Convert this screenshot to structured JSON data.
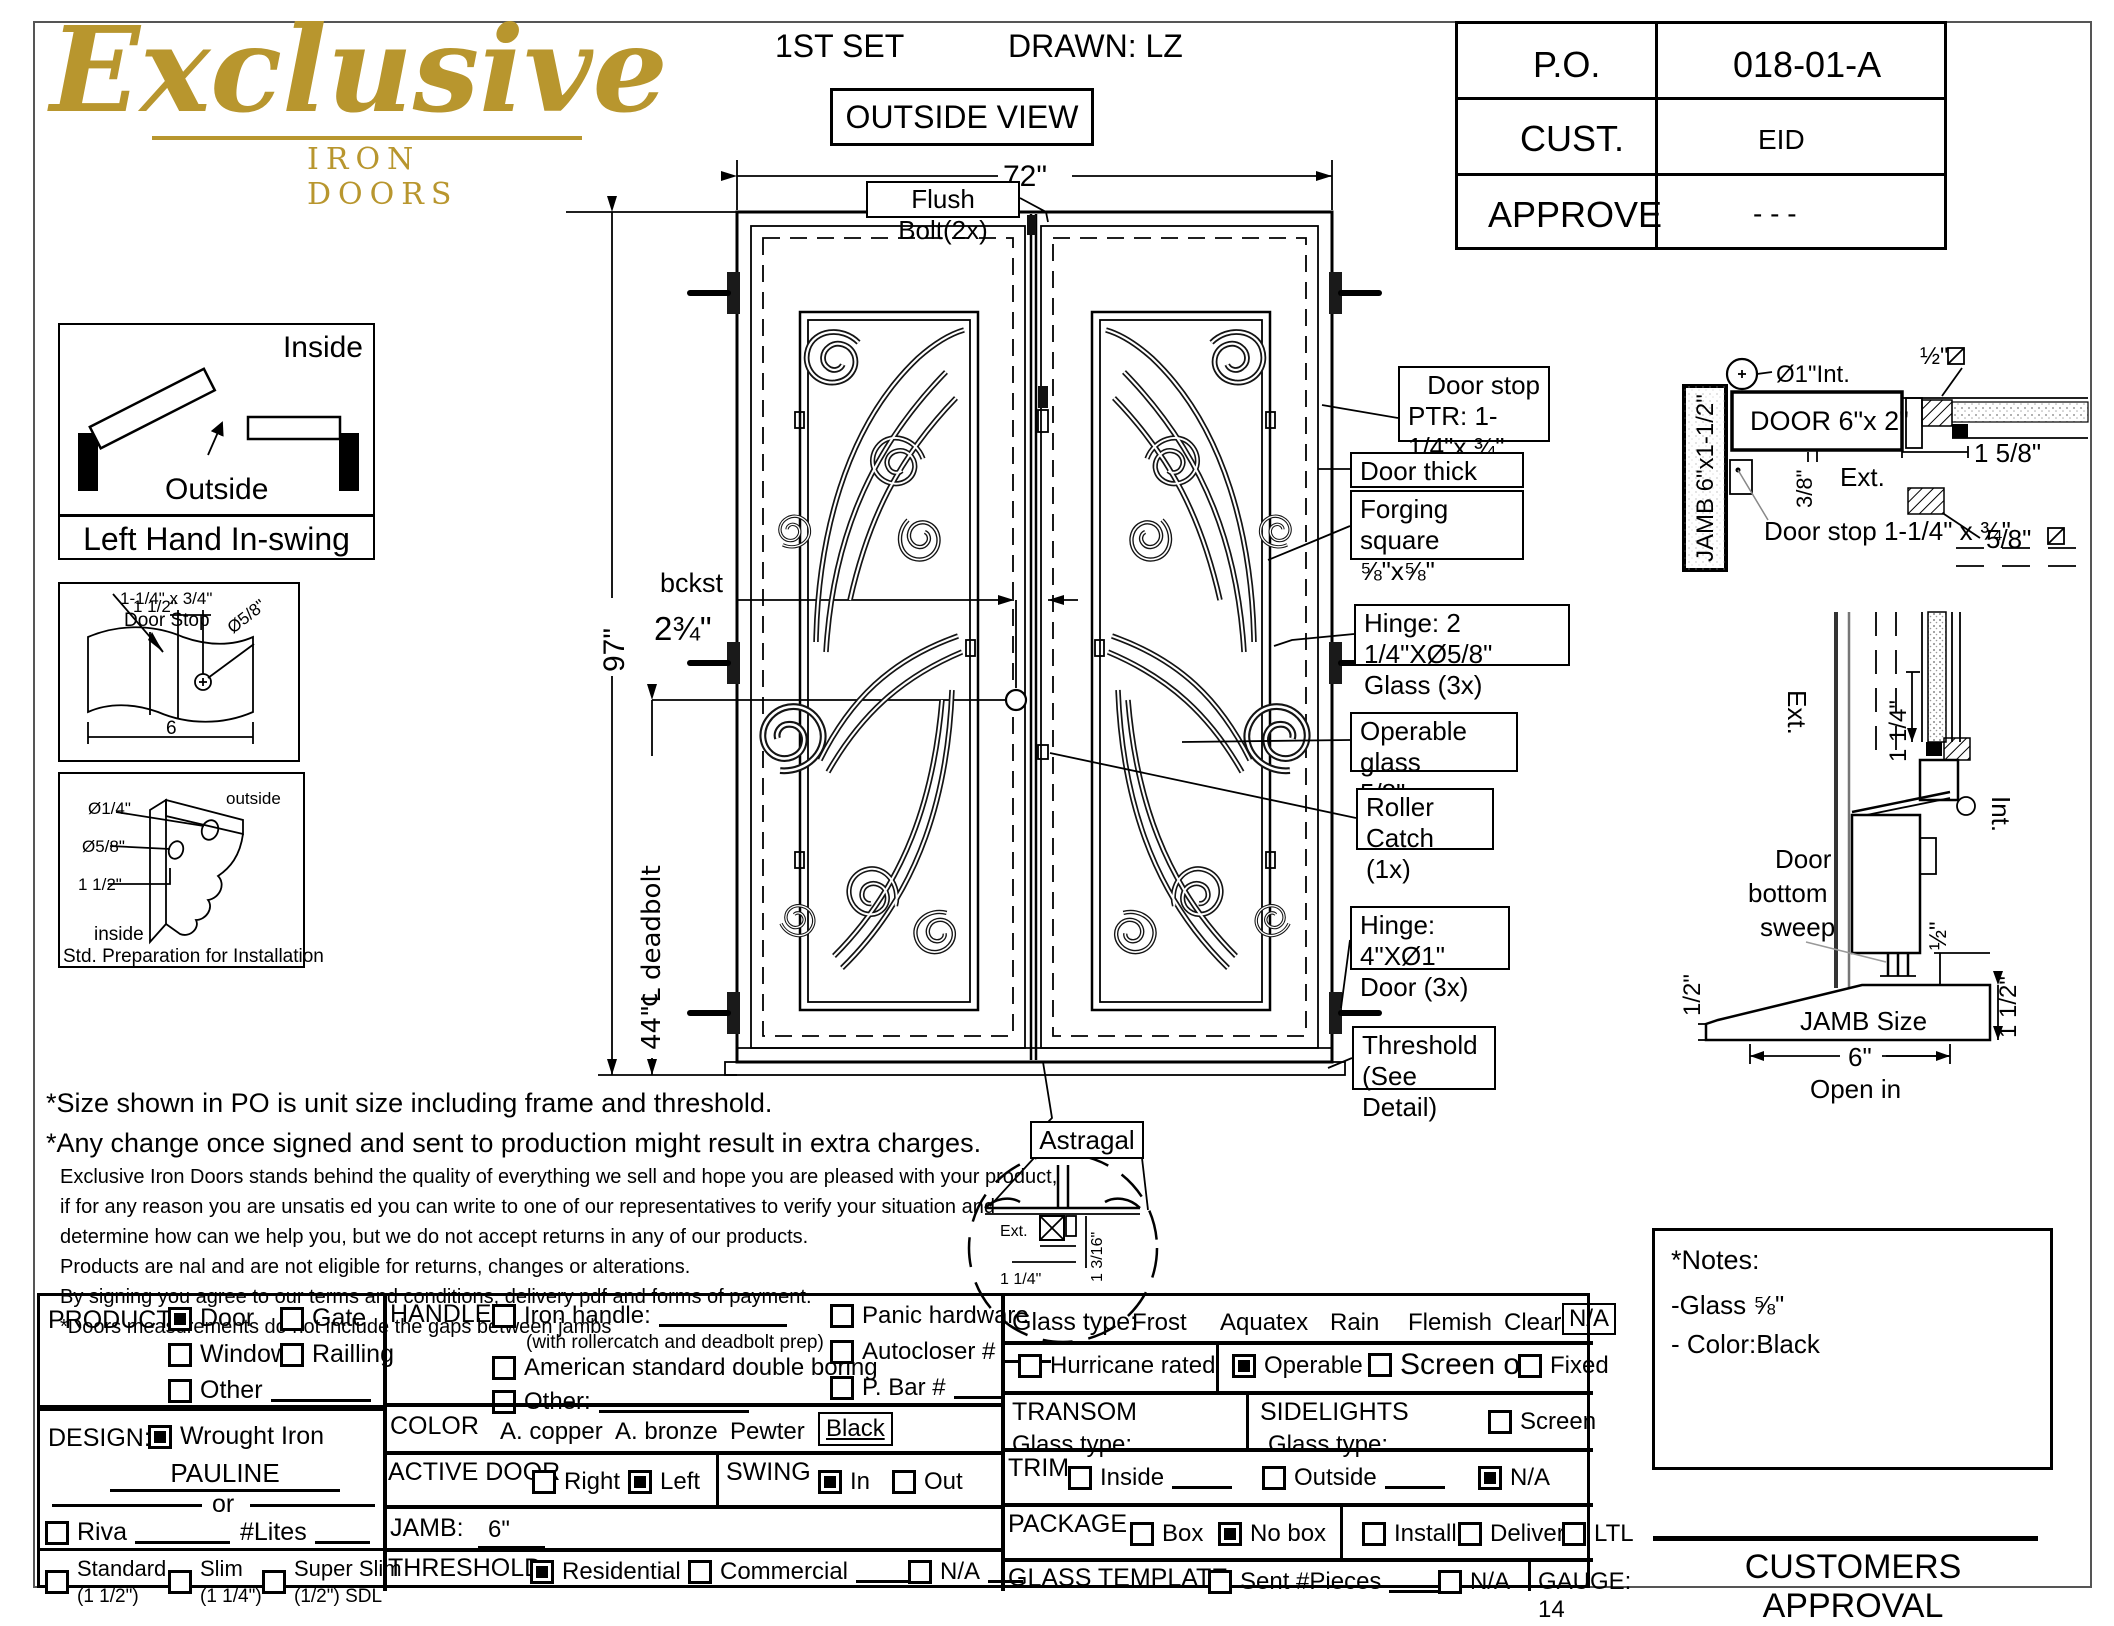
{
  "logo": {
    "script": "Exclusive",
    "sub": "IRON DOORS"
  },
  "header": {
    "set_label": "1ST SET",
    "drawn_label": "DRAWN: LZ",
    "view_label": "OUTSIDE VIEW",
    "po": [
      {
        "label": "P.O.",
        "value": "018-01-A"
      },
      {
        "label": "CUST.",
        "value": "EID"
      },
      {
        "label": "APPROVE",
        "value": "- - -"
      }
    ]
  },
  "swing_diagram": {
    "inside": "Inside",
    "outside": "Outside",
    "caption": "Left Hand In-swing"
  },
  "door_stop_detail": {
    "size": "1-1/4\" x 3/4\"",
    "name": "Door Stop",
    "offset": "1 1/2\"",
    "hole": "Ø5/8\"",
    "width": "6"
  },
  "prep_detail": {
    "hole_small": "Ø1/4\"",
    "hole_big": "Ø5/8\"",
    "offset": "1 1/2\"",
    "outside": "outside",
    "inside": "inside",
    "caption": "Std. Preparation for Installation"
  },
  "drawing": {
    "width_dim": "72\"",
    "height_dim": "97\"",
    "deadbolt_dim": "44\"℄ deadbolt",
    "backset_label": "bckst",
    "backset_value": "2¾\"",
    "flush_bolt": "Flush Bolt(2x)",
    "astragal_label": "Astragal",
    "callouts": [
      {
        "line1": "Door stop",
        "line2": "PTR: 1-1/4\"x ¾\""
      },
      {
        "line1": "Door thick 2\"x6\"",
        "line2": ""
      },
      {
        "line1": "Forging square",
        "line2": "⅝\"x⅝\""
      },
      {
        "line1": "Hinge: 2 1/4\"XØ5/8\"",
        "line2": "Glass (3x)"
      },
      {
        "line1": "Operable glass",
        "line2": "5/8\""
      },
      {
        "line1": "Roller Catch",
        "line2": "(1x)"
      },
      {
        "line1": "Hinge: 4\"XØ1\"",
        "line2": "Door (3x)"
      },
      {
        "line1": "Threshold",
        "line2": "(See Detail)"
      }
    ],
    "astragal_detail": {
      "ext": "Ext.",
      "dim_w": "1 1/4\"",
      "dim_h": "1 3/16\""
    }
  },
  "head_jamb_detail": {
    "jamb": "JAMB 6\"x1-1/2\"",
    "dia": "Ø1\"Int.",
    "door": "DOOR 6\"x 2\"",
    "half_sq": "½\"",
    "one_five_eighth": "1 5/8\"",
    "ext": "Ext.",
    "three_eighth": "3/8\"",
    "five_eighth_sq": "5/8\"",
    "door_stop": "Door stop 1-1/4\" x ¾\""
  },
  "threshold_detail": {
    "ext": "Ext.",
    "int": "Int.",
    "one_quarter": "1 1/4\"",
    "sweep1": "Door",
    "sweep2": "bottom",
    "sweep3": "sweep",
    "half_left": "1/2\"",
    "half_right": "½\"",
    "jamb_size": "JAMB Size",
    "six": "6\"",
    "open_in": "Open in",
    "one_half": "1 1/2\""
  },
  "disclaimer": {
    "line1": "*Size shown in PO is unit size including frame and threshold.",
    "line2": "*Any change once signed and sent to production might result in extra charges.",
    "body": [
      "Exclusive Iron Doors stands behind the quality of everything we sell and hope you are pleased with your product,",
      "if for any reason you are unsatis ed you can write to one of our representatives to verify your situation and",
      "determine how can we help you, but we do not accept returns in any of our products.",
      "Products are  nal and are not eligible for returns, changes or alterations.",
      "By signing you agree to our terms and conditions, delivery pdf and forms of payment.",
      "*Doors measurements do not include the gaps between jambs"
    ]
  },
  "form": {
    "product": {
      "label": "PRODUCT:",
      "door": "Door",
      "gate": "Gate",
      "window": "Window",
      "railing": "Railling",
      "other": "Other",
      "door_checked": true
    },
    "design": {
      "label": "DESIGN:",
      "wrought": "Wrought Iron",
      "wrought_checked": true,
      "name": "PAULINE",
      "or": "or",
      "riva": "Riva",
      "lites": "#Lites",
      "standard": "Standard",
      "standard_sub": "(1 1/2\")",
      "slim": "Slim",
      "slim_sub": "(1 1/4\")",
      "superslim": "Super Slim",
      "superslim_sub": "(1/2\") SDL"
    },
    "handle": {
      "label": "HANDLE",
      "iron": "Iron handle:",
      "iron_note": "(with rollercatch and deadbolt prep)",
      "american": "American standard double boring",
      "other": "Other:",
      "panic": "Panic hardware",
      "autocloser": "Autocloser #",
      "pbar": "P. Bar #"
    },
    "color": {
      "label": "COLOR",
      "copper": "A. copper",
      "bronze": "A. bronze",
      "pewter": "Pewter",
      "black": "Black"
    },
    "active_door": {
      "label": "ACTIVE DOOR",
      "right": "Right",
      "left": "Left",
      "left_checked": true
    },
    "swing": {
      "label": "SWING",
      "in": "In",
      "out": "Out",
      "in_checked": true
    },
    "jamb": {
      "label": "JAMB:",
      "value": "6\""
    },
    "threshold": {
      "label": "THRESHOLD",
      "residential": "Residential",
      "residential_checked": true,
      "commercial": "Commercial",
      "na": "N/A"
    },
    "glass": {
      "label": "Glass type:",
      "frost": "Frost",
      "aquatex": "Aquatex",
      "rain": "Rain",
      "flemish": "Flemish",
      "clear": "Clear",
      "na": "N/A"
    },
    "hurricane": {
      "label": "Hurricane rated"
    },
    "operable_row": {
      "operable": "Operable",
      "operable_checked": true,
      "screen_or": "Screen or",
      "fixed": "Fixed"
    },
    "transom": {
      "label": "TRANSOM",
      "glass_type": "Glass type:"
    },
    "sidelights": {
      "label": "SIDELIGHTS",
      "glass_type": "Glass type:",
      "screen": "Screen"
    },
    "trim": {
      "label": "TRIM",
      "inside": "Inside",
      "outside": "Outside",
      "na": "N/A",
      "na_checked": true
    },
    "package": {
      "label": "PACKAGE",
      "box": "Box",
      "nobox": "No box",
      "nobox_checked": true,
      "install": "Install",
      "delivery": "Delivery",
      "ltl": "LTL"
    },
    "glass_template": {
      "label": "GLASS TEMPLATE",
      "sent": "Sent #Pieces",
      "na": "N/A"
    },
    "gauge": "GAUGE: 14"
  },
  "notes": {
    "title": "*Notes:",
    "glass": "-Glass ⅝\"",
    "color": "- Color:Black"
  },
  "approval": "CUSTOMERS APPROVAL"
}
